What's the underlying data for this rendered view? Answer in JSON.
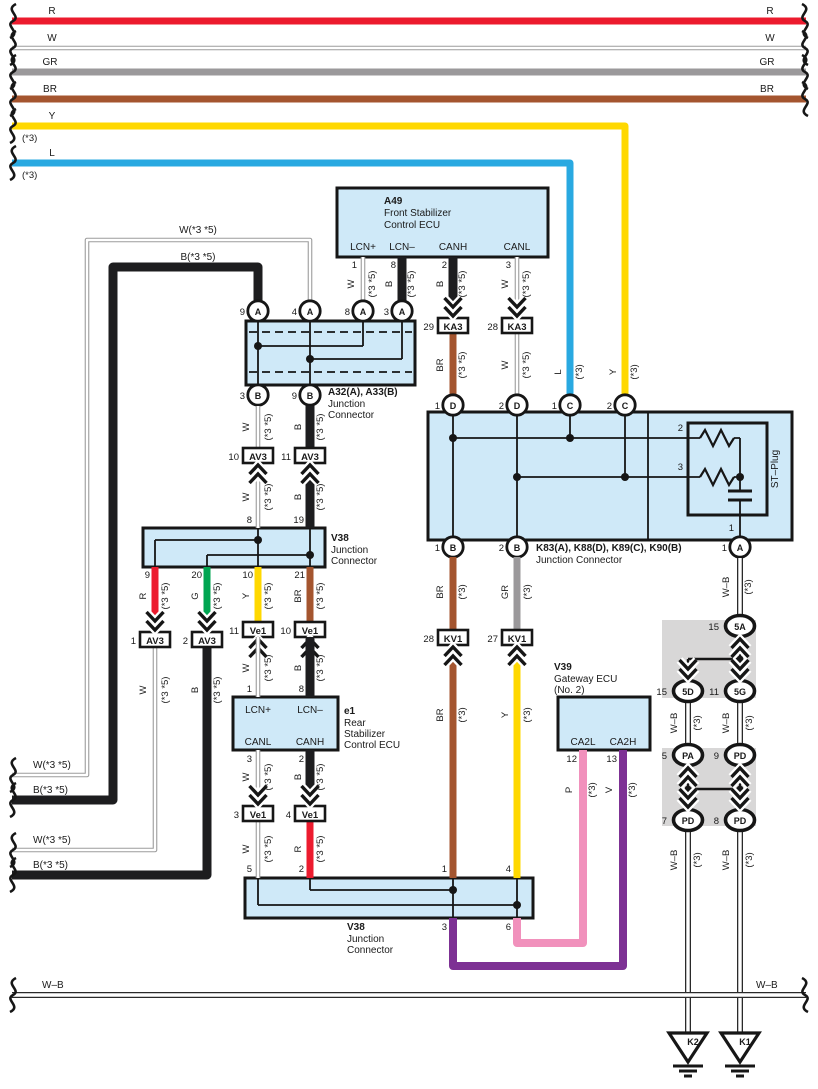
{
  "colors": {
    "red": "#ec1b2e",
    "green": "#00a551",
    "yellow": "#ffd800",
    "blue": "#29a9e1",
    "brown": "#a4552f",
    "gray": "#9b999b",
    "pink": "#f191bc",
    "violet": "#7d3194",
    "black-wire": "#1d1d1f",
    "white-wire-edge": "#9c9c9c",
    "wb-wire": "#2a2a2a",
    "panel-blue": "#cfe9f8",
    "shade-gray": "#d8d7d7"
  },
  "bus": {
    "r": "R",
    "w": "W",
    "gr": "GR",
    "br": "BR",
    "y": "Y",
    "l": "L",
    "y_note": "(*3)",
    "l_note": "(*3)"
  },
  "ecu_a49": {
    "code": "A49",
    "name1": "Front Stabilizer",
    "name2": "Control ECU",
    "pin_lcnp": "LCN+",
    "pin_lcnn": "LCN–",
    "pin_canh": "CANH",
    "pin_canl": "CANL",
    "num_lcnp": "1",
    "num_lcnn": "8",
    "num_canh": "2",
    "num_canl": "3"
  },
  "ecu_e1": {
    "code": "e1",
    "name1": "Rear",
    "name2": "Stabilizer",
    "name3": "Control ECU",
    "pin_lcnp": "LCN+",
    "pin_lcnn": "LCN–",
    "pin_canl": "CANL",
    "pin_canh": "CANH",
    "num_lcnp": "1",
    "num_lcnn": "8",
    "num_canl": "3",
    "num_canh": "2"
  },
  "ecu_v39": {
    "code": "V39",
    "name1": "Gateway ECU",
    "name2": "(No. 2)",
    "pin_ca2l": "CA2L",
    "pin_ca2h": "CA2H",
    "num_ca2l": "12",
    "num_ca2h": "13"
  },
  "jc_a32": {
    "title": "A32(A), A33(B)",
    "sub1": "Junction",
    "sub2": "Connector",
    "pins_top": [
      {
        "num": "9",
        "letter": "A"
      },
      {
        "num": "4",
        "letter": "A"
      },
      {
        "num": "8",
        "letter": "A"
      },
      {
        "num": "3",
        "letter": "A"
      }
    ],
    "pins_bottom": [
      {
        "num": "3",
        "letter": "B"
      },
      {
        "num": "9",
        "letter": "B"
      }
    ]
  },
  "jc_v38_top": {
    "title": "V38",
    "sub1": "Junction",
    "sub2": "Connector",
    "num_8": "8",
    "num_19": "19",
    "num_9": "9",
    "num_20": "20",
    "num_10": "10",
    "num_21": "21"
  },
  "jc_v38_bot": {
    "title": "V38",
    "sub1": "Junction",
    "sub2": "Connector",
    "num_5": "5",
    "num_2": "2",
    "num_1": "1",
    "num_4": "4",
    "num_3": "3",
    "num_6": "6"
  },
  "jc_k83": {
    "title": "K83(A), K88(D), K89(C), K90(B)",
    "sub": "Junction Connector",
    "st_plug": "ST–Plug",
    "st_2": "2",
    "st_3": "3",
    "st_1": "1",
    "pin_d1": {
      "num": "1",
      "letter": "D"
    },
    "pin_d2": {
      "num": "2",
      "letter": "D"
    },
    "pin_c1": {
      "num": "1",
      "letter": "C"
    },
    "pin_c2": {
      "num": "2",
      "letter": "C"
    },
    "pin_b1": {
      "num": "1",
      "letter": "B"
    },
    "pin_b2": {
      "num": "2",
      "letter": "B"
    },
    "pin_a1": {
      "num": "1",
      "letter": "A"
    }
  },
  "connectors": {
    "ka3_29": {
      "num": "29",
      "name": "KA3"
    },
    "ka3_28": {
      "num": "28",
      "name": "KA3"
    },
    "av3_10": {
      "num": "10",
      "name": "AV3"
    },
    "av3_11": {
      "num": "11",
      "name": "AV3"
    },
    "av3_1": {
      "num": "1",
      "name": "AV3"
    },
    "av3_2": {
      "num": "2",
      "name": "AV3"
    },
    "ve1_11": {
      "num": "11",
      "name": "Ve1"
    },
    "ve1_10": {
      "num": "10",
      "name": "Ve1"
    },
    "ve1_3": {
      "num": "3",
      "name": "Ve1"
    },
    "ve1_4": {
      "num": "4",
      "name": "Ve1"
    },
    "kv1_28": {
      "num": "28",
      "name": "KV1"
    },
    "kv1_27": {
      "num": "27",
      "name": "KV1"
    },
    "c5a": {
      "num": "15",
      "name": "5A"
    },
    "c5d": {
      "num": "15",
      "name": "5D"
    },
    "c5g": {
      "num": "11",
      "name": "5G"
    },
    "cpa": {
      "num": "5",
      "name": "PA"
    },
    "cpd9": {
      "num": "9",
      "name": "PD"
    },
    "cpd7": {
      "num": "7",
      "name": "PD"
    },
    "cpd8": {
      "num": "8",
      "name": "PD"
    }
  },
  "wires": {
    "a49_lcnp": {
      "c": "W",
      "n": "(*3 *5)"
    },
    "a49_lcnn": {
      "c": "B",
      "n": "(*3 *5)"
    },
    "a49_canh": {
      "c": "B",
      "n": "(*3 *5)"
    },
    "a49_canl": {
      "c": "W",
      "n": "(*3 *5)"
    },
    "ka3_br": {
      "c": "BR",
      "n": "(*3 *5)"
    },
    "ka3_w": {
      "c": "W",
      "n": "(*3 *5)"
    },
    "drop_l": {
      "c": "L",
      "n": "(*3)"
    },
    "drop_y": {
      "c": "Y",
      "n": "(*3)"
    },
    "loop_w": "W(*3 *5)",
    "loop_b": "B(*3 *5)",
    "exit1_w": "W(*3 *5)",
    "exit1_b": "B(*3 *5)",
    "exit2_w": "W(*3 *5)",
    "exit2_b": "B(*3 *5)",
    "a32_w": {
      "c": "W",
      "n": "(*3 *5)"
    },
    "a32_b": {
      "c": "B",
      "n": "(*3 *5)"
    },
    "av3_w": {
      "c": "W",
      "n": "(*3 *5)"
    },
    "av3_b": {
      "c": "B",
      "n": "(*3 *5)"
    },
    "v38_r": {
      "c": "R",
      "n": "(*3 *5)"
    },
    "v38_g": {
      "c": "G",
      "n": "(*3 *5)"
    },
    "v38_y": {
      "c": "Y",
      "n": "(*3 *5)"
    },
    "v38_br": {
      "c": "BR",
      "n": "(*3 *5)"
    },
    "low_w": {
      "c": "W",
      "n": "(*3 *5)"
    },
    "low_b": {
      "c": "B",
      "n": "(*3 *5)"
    },
    "ve1_w": {
      "c": "W",
      "n": "(*3 *5)"
    },
    "ve1_b": {
      "c": "B",
      "n": "(*3 *5)"
    },
    "e1_canl": {
      "c": "W",
      "n": "(*3 *5)"
    },
    "e1_canh": {
      "c": "B",
      "n": "(*3 *5)"
    },
    "ve1low_w": {
      "c": "W",
      "n": "(*3 *5)"
    },
    "ve1low_r": {
      "c": "R",
      "n": "(*3 *5)"
    },
    "kb_br": {
      "c": "BR",
      "n": "(*3)"
    },
    "kb_gr": {
      "c": "GR",
      "n": "(*3)"
    },
    "kb_wb": {
      "c": "W–B",
      "n": "(*3)"
    },
    "kv1_br": {
      "c": "BR",
      "n": "(*3)"
    },
    "kv1_y": {
      "c": "Y",
      "n": "(*3)"
    },
    "v39_p": {
      "c": "P",
      "n": "(*3)"
    },
    "v39_v": {
      "c": "V",
      "n": "(*3)"
    },
    "gb1_l": {
      "c": "W–B",
      "n": "(*3)"
    },
    "gb1_r": {
      "c": "W–B",
      "n": "(*3)"
    },
    "gb2_l": {
      "c": "W–B",
      "n": "(*3)"
    },
    "gb2_r": {
      "c": "W–B",
      "n": "(*3)"
    },
    "wb_bus_left": "W–B",
    "wb_bus_right": "W–B"
  },
  "grounds": {
    "k2": "K2",
    "k1": "K1"
  }
}
